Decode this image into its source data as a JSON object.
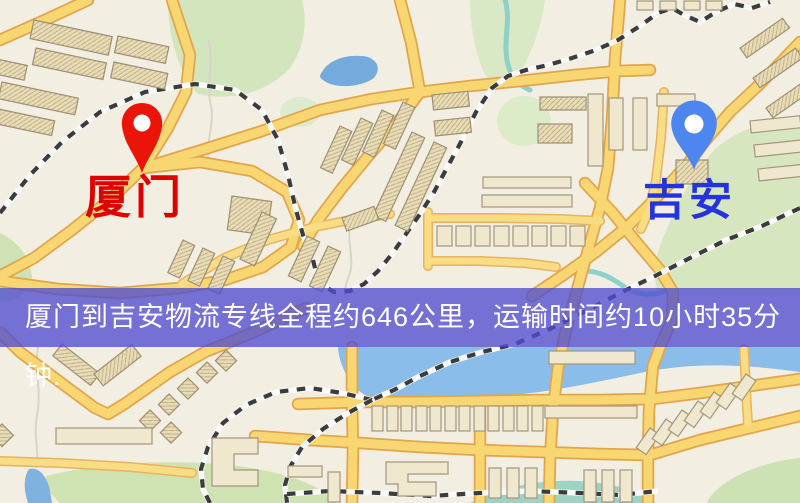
{
  "banner": {
    "text": "厦门到吉安物流专线全程约646公里，运输时间约10小时35分钟.",
    "background_color": "#4f4dd0",
    "text_color": "#ffffff"
  },
  "map": {
    "origin": {
      "label": "厦门",
      "label_color": "#e10000",
      "pin_color": "#ea1508",
      "pin_icon": "red-map-pin"
    },
    "destination": {
      "label": "吉安",
      "label_color": "#2433e0",
      "pin_color": "#4e86f0",
      "pin_icon": "blue-map-pin"
    },
    "theme": {
      "background": "#f3eee2",
      "road_fill": "#f8d671",
      "road_casing": "#e2a54c",
      "building_fill": "#f0e7cf",
      "green_area": "#d3e5bd",
      "water": "#8abdea",
      "river": "#8fd0cb",
      "railway": "#3c3c3c"
    }
  }
}
